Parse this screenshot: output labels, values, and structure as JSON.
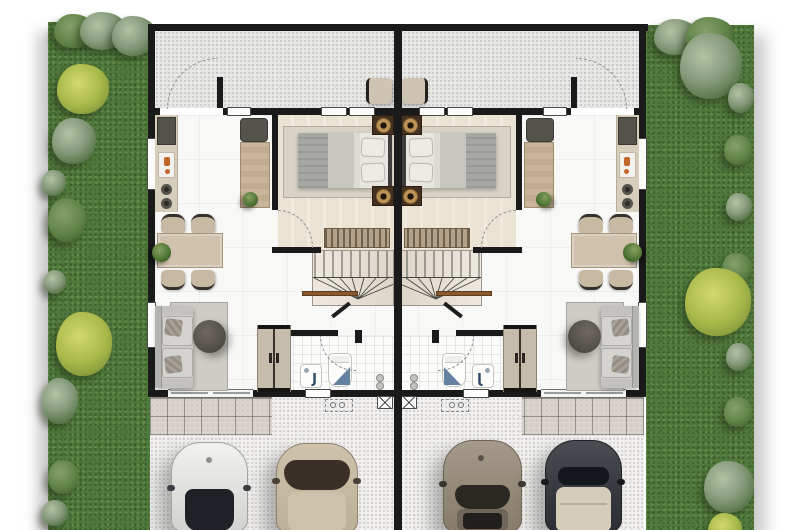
{
  "scene": {
    "kind": "architectural-floor-plan",
    "view": "top-down",
    "units": 2,
    "mirrored_layout": true
  },
  "rooms": [
    "rear-terrace",
    "bedroom",
    "kitchen",
    "dining-area",
    "living-room",
    "bathroom",
    "staircase",
    "entry-porch",
    "driveway",
    "side-garden"
  ],
  "furniture_per_unit": [
    "kitchen-counter",
    "stove",
    "sink",
    "hob-burners",
    "study-desk",
    "desk-chair",
    "desk-plant",
    "dining-table",
    "dining-chairs-x4",
    "table-plant",
    "sofa",
    "throw-pillows",
    "round-coffee-table",
    "living-rug",
    "double-bed",
    "bed-pillows",
    "nightstands-x2",
    "table-lamps-x2",
    "dresser",
    "wardrobe",
    "bedroom-rug",
    "staircase-with-winders",
    "stair-rail",
    "toilet",
    "washbasin",
    "floor-drains",
    "terrace-chair",
    "washing-machine-outline",
    "utility-outline",
    "front-sliding-door"
  ],
  "vehicles": [
    "white-car",
    "champagne-car",
    "taupe-car",
    "dark-car-beige-roof"
  ],
  "counts": {
    "cars": 4,
    "gardens": 2,
    "bathrooms_visible": 2,
    "beds_visible": 2
  },
  "glyphs": {
    "basin_faucet": "J"
  },
  "palette": {
    "background": "#ffffff",
    "wall": "#1a1a1a",
    "grass": "#50793c",
    "bush_gray_green": "#879b7c",
    "bush_yellow_green": "#aaba4b",
    "terrace_speckle": "#e9e9e7",
    "driveway_speckle": "#f2f1ef",
    "interior_floor": "#f8f8f6",
    "bedroom_planks": "#eae2d3",
    "porch_tile": "#d8d4cd",
    "counter_tan": "#d7cdbb",
    "wood_desk": "#c9b59a",
    "sofa_gray": "#cbcac6",
    "coffee_table": "#54504a",
    "lamp_brass": "#bb9155",
    "stair_rail_brown": "#8a5a2e",
    "bath_blue": "#64819f",
    "car_white": "#e9e9e7",
    "car_champagne": "#c7baa3",
    "car_taupe": "#978b7d",
    "car_dark": "#3a3d41"
  }
}
